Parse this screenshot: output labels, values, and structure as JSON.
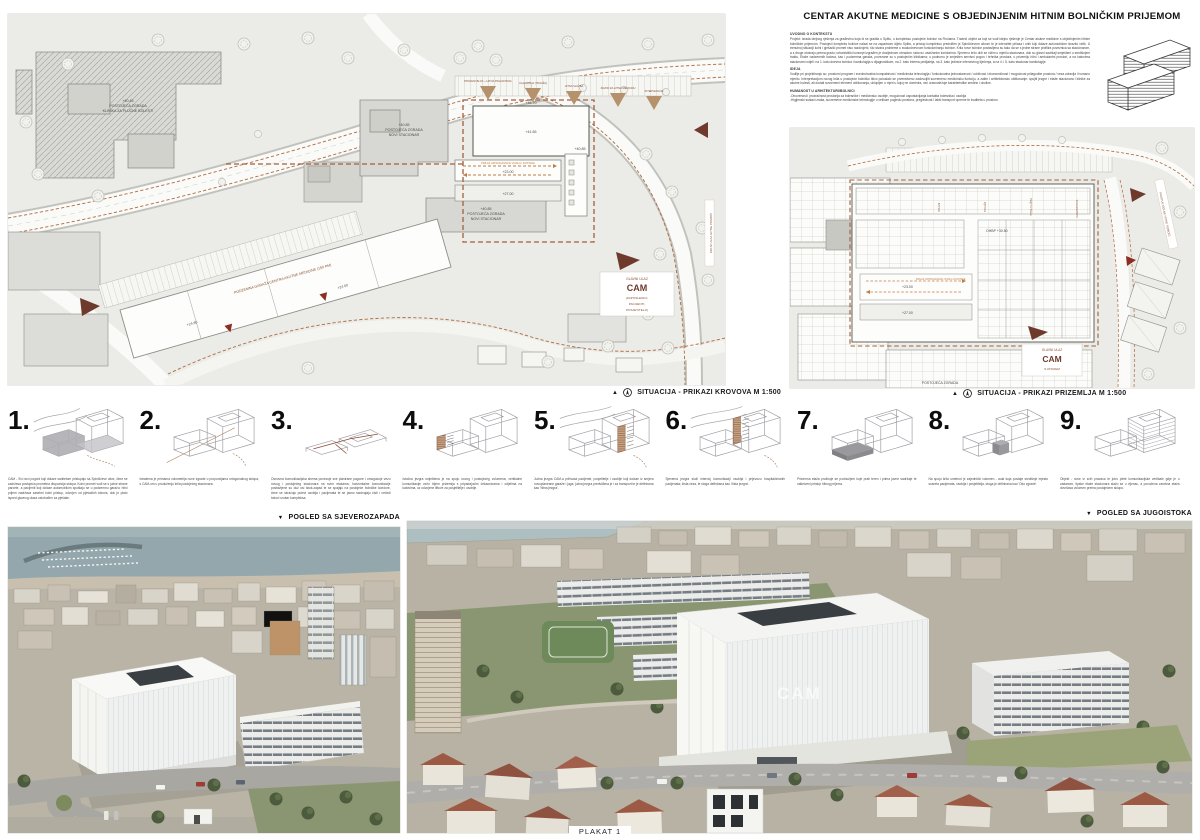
{
  "page": {
    "title": "CENTAR AKUTNE MEDICINE S OBJEDINJENIM HITNIM BOLNIČKIM PRIJEMOM",
    "plakat_label": "PLAKAT 1"
  },
  "colors": {
    "accent_orange": "#b06a3c",
    "marker_brown": "#6e3a2c",
    "tan_triangle": "#b5916c",
    "plan_background": "#ebebe8",
    "building_gray": "#d8d8d4",
    "green": "#6f7f57",
    "sea": "#93a7ac",
    "roof_red": "#9c5a45"
  },
  "intro": {
    "sections": [
      {
        "heading": "UVODNO O KONTEKSTU",
        "body": "Projekt: izrada idejnog rješenja za građevinu koja bi se gradila u Splitu, u kompleksu postojeće bolnice na Firulama. Tražeći objekt za koji se vodi idejno rješenje je Centar akutne medicine s objedinjenim hitnim bolničkim prijemom. Postojeći kompleks bolnice nalazi se na zapadnom dijelu Splita, a pristup kompleksu predviđen je Spinčićevom ulicom te je intenzitet prilaza i onih koji dolaze automobilom izrazito velik. U trenutnoj situaciji kolni i pješački promet nisu razdvojeni, što stvara probleme u svakodnevnom funkcioniranju bolnice. Krila nove bolnice postavljena su tako da se s jedne strane profilira poveznica sa stacionarom, a s druge otvaraju prema gradu; urbanistički koncept izgrađen je dosljednom obradom rubova i zadržanim koridorima. Sjeverno krilo drži se nižim u mjerilu stacionara, dok su glavni sadržaji smješteni u središnjem traktu. Etaže nadzemnih katova, kao i podzemna garaža, povezane su s postojećim klinikama; u podrumu je smješten servisni pogon i tehnika prostora, u prizemlju hitni i ambulantni prostori, a na katovima stacionarni odjeli: na 1. katu dnevna bolnica i kardiologija s dijagnostikom, na 2. katu interna pedijatrija, na 3. katu jedinice intenzivnog liječenja, a na 4. i 5. katu stacionar kardiologije."
      },
      {
        "heading": "IDEJA",
        "body": "Vodilje pri projektiranju su: prostorni program i sveobuhvatna kompaktnost / medicinska tehnologija / funkcionalna jednostavnost / održivost i ekonomičnost / mogućnost prilagodbe prostora / veza zdravlja i humano mjerilo. Interpretacijom novog krila u postojeće bolničko tkivo pokušalo se prvenstveno zadovoljiti suvremenu medicinsku funkciju, a zatim i arhitektonsko oblikovanje: spojiti jezgre i etaže stacionara i klinike za akutne bolesti, ali dodati suvremeni element oblikovanja, uklopljen u mjeri u kojoj ne dominira, već uravnotežuje karakteristike sredine i okoline."
      },
      {
        "heading": "HUMANOST U ARHITEKTURI/BOLNICI",
        "body": "-Otvorenost i prozračnost prostorija za bolesnike i medicinsko osoblje, mogućnost uspostavljanja kontakta bolesnika i osoblja\n-Higijenski sustavi zraka, suvremene medicinske tehnologije u velikom pogledu prostora, preglednost i lakši transport opreme te kvaliteta u prostoru"
      }
    ]
  },
  "left_plan": {
    "caption": "SITUACIJA - PRIKAZI KROVOVA M 1:500",
    "labels": {
      "existing_top": [
        "+40.85",
        "POSTOJEĆA ZGRADA",
        "NOVI STACIONAR"
      ],
      "existing_bottom": [
        "+40.85",
        "POSTOJEĆA ZGRADA",
        "NOVI STACIONAR"
      ],
      "clinic": [
        "+40.45",
        "POSTOJEĆA ZGRADA",
        "KLINIKA ZA PLUĆNE BOLESTI"
      ],
      "e4670": "+46.70",
      "e4165": "+41.65",
      "e4085": "+40.85",
      "e2300": "+23.00",
      "e2700": "+27.00",
      "e2480": "+24.80",
      "e2400": "+24.00",
      "corridor_note": "PRILAZ VATROGASNOG VOZILA I DOSTAVE",
      "garage": "PODZEMNA GARAŽA CENTRA AKUTNE MEDICINE (150 PM)",
      "entry": [
        "GLAVNI ULAZ",
        "CAM",
        "(ZAPOSLENICI,",
        "PACIJENTI,",
        "POSJETITELJI)"
      ],
      "gates": [
        "PRIJAVNI BLOK + HITNA PSIHIJATRIJA",
        "ULAZ HITNA (TRIJAŽA)",
        "HITNA SLUŽBA",
        "ZAVOD ZA HITNU MEDICINU",
        "INTERVENCIJE"
      ],
      "side_label": "KOLNI ULAZ HITNE POMOĆI"
    }
  },
  "right_plan": {
    "caption": "SITUACIJA - PRIKAZI PRIZEMLJA M 1:500",
    "labels": {
      "ohbp": "OHBP +30.50",
      "e2300": "+23.00",
      "e2700": "+27.00",
      "existing": "POSTOJEĆA ZGRADA",
      "entry": [
        "GLAVNI ULAZ",
        "CAM",
        "S ATRIJEM"
      ],
      "wards": [
        "PRIJEM",
        "TRIJAŽA",
        "HITNA SLUŽBA",
        "DIJAGNOSTIKA"
      ],
      "side_label": "PRISTUP KOLNE HITNE POMOĆI",
      "corridor_note": "PRILAZ VATROGASNOG VOZILA I DOSTAVE"
    }
  },
  "diagrams": [
    {
      "num": "1.",
      "caption": "CAM - Svi novi pogoni koji dolaze sanitetom pristupaju sa Spinčićeve ulice, čime se zadržava postojeća prometna dispozicija sklopa. Kolni promet vodi se s južne strane parcele, a pacijenti koji dolaze automobilom spuštaju se u podzemnu garažu; hitni prijem zadržava zasebni kolni pristup, odvojen od pješačkih tokova, dok je plato ispred glavnog ulaza oslobođen za pješake."
    },
    {
      "num": "2.",
      "caption": "Istražena je primarna volumetrija nove zgrade u proporcijama ortogonalnog sklopa, s CAM-om u produženju krila postojećeg stacionara."
    },
    {
      "num": "3.",
      "caption": "Osnovna komunikacijska shema povezuje sve planirane pogone i omogućuje vezu novog i postojećeg stacionara na svim etažama; horizontalne komunikacije postavljene su duž osi istok-zapad te se spajaju na postojeće bolničke koridore, čime se skraćuju putevi osoblja i pacijenata te se jasno razdvajaju čisti i nečisti tokovi unutar kompleksa."
    },
    {
      "num": "4.",
      "caption": "Istočna jezgra smještena je na spoju novog i postojećeg volumena; vertikalne komunikacije vežu trijem prizemlja s pripadajućim čekaonicama i odjelima na katovima, uz odvojene liftove za posjetitelje i osoblje."
    },
    {
      "num": "5.",
      "caption": "Južna jezgra CAM-a prihvaća pacijente, posjetitelje i osoblje koji dolaze iz smjera novoplanirane garaže i juga; južna jezgra predviđena je i za transport te je definirana kao 'hitna jezgra'."
    },
    {
      "num": "6.",
      "caption": "Sjeverna jezgra služi internoj komunikaciji osoblja i prijevozu hospitaliziranih pacijenata; čista veza, te stoga definirana kao 'čista jezgra'."
    },
    {
      "num": "7.",
      "caption": "Prizemna etaža proširuje se podnožjem koje prati teren i prima javne sadržaje te natkriveni pristup hitnog prijema."
    },
    {
      "num": "8.",
      "caption": "Na spoju krila umetnut je zajednički volumen - aula koja postaje središnje mjesto susreta pacijenata, osoblja i posjetitelja, stoga je definirana kao 'Oko zgrade'."
    },
    {
      "num": "9.",
      "caption": "Objekt - nove iz svih pravaca te jutro plete komunikacijske vertikale gdje je u zadanom, tipske etaže stacionara slažu se u vijenac, a povučena završna etaža dovršava volumen prema postojećem sklopu."
    }
  ],
  "views": {
    "northwest": "POGLED SA SJEVEROZAPADA",
    "southeast": "POGLED SA JUGOISTOKA"
  },
  "photo_right": {
    "facade_text": "CAM"
  }
}
